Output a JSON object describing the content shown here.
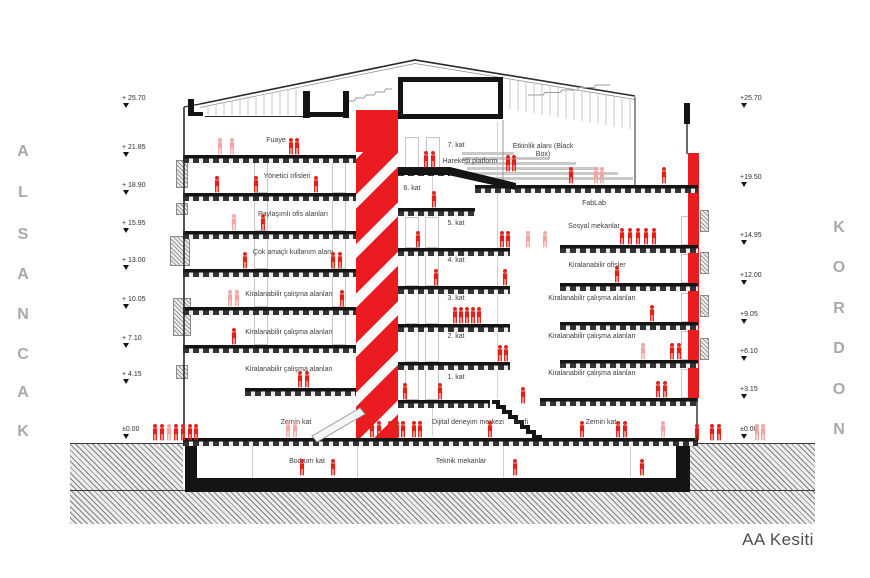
{
  "meta": {
    "title": "AA Kesiti"
  },
  "side_labels": {
    "left": "ALSANCAK",
    "right": "KORDON"
  },
  "colors": {
    "accent": "#ea1c22",
    "figure": "#e32119",
    "figure_light": "#f1a6a4",
    "ink": "#141414",
    "letters": "#a9a9a9"
  },
  "elevations": {
    "left": [
      {
        "label": "+ 25.70",
        "y": 99
      },
      {
        "label": "+ 21.85",
        "y": 148
      },
      {
        "label": "+ 18.90",
        "y": 186
      },
      {
        "label": "+ 15.95",
        "y": 224
      },
      {
        "label": "+ 13.00",
        "y": 261
      },
      {
        "label": "+ 10.05",
        "y": 300
      },
      {
        "label": "+ 7.10",
        "y": 339
      },
      {
        "label": "+ 4.15",
        "y": 375
      },
      {
        "label": "±0.00",
        "y": 430
      }
    ],
    "right": [
      {
        "label": "+25.70",
        "y": 99
      },
      {
        "label": "+19.50",
        "y": 178
      },
      {
        "label": "+14.95",
        "y": 236
      },
      {
        "label": "+12.00",
        "y": 276
      },
      {
        "label": "+9.05",
        "y": 315
      },
      {
        "label": "+6.10",
        "y": 352
      },
      {
        "label": "+3.15",
        "y": 390
      },
      {
        "label": "±0.00",
        "y": 430
      }
    ]
  },
  "rooms": [
    {
      "t": "Fuaye",
      "x": 276,
      "y": 141,
      "w": 80
    },
    {
      "t": "Yönetici ofisleri",
      "x": 287,
      "y": 177,
      "w": 90
    },
    {
      "t": "Paylaşımlı ofis alanları",
      "x": 293,
      "y": 215,
      "w": 110
    },
    {
      "t": "Çok amaçlı kullanım alanı",
      "x": 293,
      "y": 253,
      "w": 120
    },
    {
      "t": "Kiralanabilir çalışma alanları",
      "x": 289,
      "y": 295,
      "w": 95
    },
    {
      "t": "Kiralanabilir çalışma alanları",
      "x": 289,
      "y": 333,
      "w": 95
    },
    {
      "t": "Kiralanabilir çalışma alanları",
      "x": 289,
      "y": 370,
      "w": 95
    },
    {
      "t": "Zemin kat",
      "x": 296,
      "y": 423,
      "w": 60
    },
    {
      "t": "Bodrum kat",
      "x": 307,
      "y": 462,
      "w": 70
    },
    {
      "t": "7. kat",
      "x": 456,
      "y": 146,
      "w": 40
    },
    {
      "t": "Hareketli platform",
      "x": 470,
      "y": 162,
      "w": 115
    },
    {
      "t": "6. kat",
      "x": 412,
      "y": 189,
      "w": 40
    },
    {
      "t": "5. kat",
      "x": 456,
      "y": 224,
      "w": 40
    },
    {
      "t": "4. kat",
      "x": 456,
      "y": 261,
      "w": 40
    },
    {
      "t": "3. kat",
      "x": 456,
      "y": 299,
      "w": 40
    },
    {
      "t": "2. kat",
      "x": 456,
      "y": 337,
      "w": 40
    },
    {
      "t": "1. kat",
      "x": 456,
      "y": 378,
      "w": 40
    },
    {
      "t": "Dijital deneyim merkezi",
      "x": 468,
      "y": 423,
      "w": 115
    },
    {
      "t": "Amfi",
      "x": 521,
      "y": 423,
      "w": 40
    },
    {
      "t": "Zemin kat",
      "x": 601,
      "y": 423,
      "w": 60
    },
    {
      "t": "Teknik mekanlar",
      "x": 461,
      "y": 462,
      "w": 95
    },
    {
      "t": "Etkinlik alanı (Black Box)",
      "x": 543,
      "y": 151,
      "w": 75
    },
    {
      "t": "FabLab",
      "x": 594,
      "y": 204,
      "w": 60
    },
    {
      "t": "Sosyal mekanlar",
      "x": 594,
      "y": 227,
      "w": 90
    },
    {
      "t": "Kiralanabilir ofisler",
      "x": 597,
      "y": 266,
      "w": 100
    },
    {
      "t": "Kiralanabilir çalışma alanları",
      "x": 592,
      "y": 299,
      "w": 98
    },
    {
      "t": "Kiralanabilir çalışma alanları",
      "x": 592,
      "y": 337,
      "w": 98
    },
    {
      "t": "Kiralanabilir çalışma alanları",
      "x": 592,
      "y": 374,
      "w": 98
    }
  ],
  "people": [
    [
      155,
      441
    ],
    [
      162,
      441
    ],
    [
      169,
      441,
      "l"
    ],
    [
      176,
      441
    ],
    [
      183,
      441
    ],
    [
      190,
      441
    ],
    [
      196,
      441
    ],
    [
      220,
      155,
      "l"
    ],
    [
      232,
      155,
      "l"
    ],
    [
      291,
      155
    ],
    [
      297,
      155
    ],
    [
      426,
      168
    ],
    [
      433,
      168
    ],
    [
      508,
      172
    ],
    [
      514,
      172
    ],
    [
      571,
      184
    ],
    [
      596,
      184,
      "l"
    ],
    [
      602,
      184,
      "l"
    ],
    [
      664,
      184
    ],
    [
      217,
      193
    ],
    [
      256,
      193
    ],
    [
      316,
      193
    ],
    [
      434,
      208
    ],
    [
      234,
      231,
      "l"
    ],
    [
      263,
      231
    ],
    [
      418,
      248
    ],
    [
      502,
      248
    ],
    [
      508,
      248
    ],
    [
      528,
      248,
      "l"
    ],
    [
      545,
      248,
      "l"
    ],
    [
      622,
      245
    ],
    [
      630,
      245
    ],
    [
      638,
      245
    ],
    [
      646,
      245
    ],
    [
      654,
      245
    ],
    [
      245,
      269
    ],
    [
      333,
      269
    ],
    [
      340,
      269
    ],
    [
      436,
      286
    ],
    [
      505,
      286
    ],
    [
      617,
      283
    ],
    [
      230,
      307,
      "l"
    ],
    [
      237,
      307,
      "l"
    ],
    [
      342,
      307
    ],
    [
      455,
      324
    ],
    [
      461,
      324
    ],
    [
      467,
      324
    ],
    [
      473,
      324
    ],
    [
      479,
      324
    ],
    [
      652,
      322
    ],
    [
      234,
      345
    ],
    [
      500,
      362
    ],
    [
      506,
      362
    ],
    [
      643,
      360,
      "l"
    ],
    [
      672,
      360
    ],
    [
      679,
      360
    ],
    [
      300,
      388
    ],
    [
      307,
      388
    ],
    [
      405,
      400
    ],
    [
      440,
      400
    ],
    [
      658,
      398
    ],
    [
      665,
      398
    ],
    [
      523,
      404
    ],
    [
      288,
      438,
      "l"
    ],
    [
      295,
      438,
      "l"
    ],
    [
      372,
      438
    ],
    [
      379,
      438
    ],
    [
      390,
      438
    ],
    [
      397,
      438
    ],
    [
      403,
      438
    ],
    [
      414,
      438
    ],
    [
      420,
      438
    ],
    [
      490,
      438
    ],
    [
      582,
      438
    ],
    [
      618,
      438
    ],
    [
      625,
      438
    ],
    [
      663,
      438,
      "l"
    ],
    [
      697,
      441
    ],
    [
      712,
      441
    ],
    [
      719,
      441
    ],
    [
      757,
      441,
      "l"
    ],
    [
      763,
      441,
      "l"
    ],
    [
      302,
      476
    ],
    [
      333,
      476
    ],
    [
      515,
      476
    ],
    [
      642,
      476
    ]
  ],
  "structure": {
    "slabs": [
      [
        183,
        155,
        173
      ],
      [
        183,
        193,
        173
      ],
      [
        183,
        231,
        173
      ],
      [
        183,
        269,
        173
      ],
      [
        183,
        307,
        173
      ],
      [
        183,
        345,
        173
      ],
      [
        245,
        388,
        111
      ],
      [
        398,
        168,
        52
      ],
      [
        398,
        208,
        77
      ],
      [
        398,
        248,
        112
      ],
      [
        398,
        286,
        112
      ],
      [
        398,
        324,
        112
      ],
      [
        398,
        362,
        112
      ],
      [
        398,
        400,
        92
      ],
      [
        475,
        185,
        223
      ],
      [
        560,
        245,
        138
      ],
      [
        560,
        283,
        138
      ],
      [
        560,
        322,
        138
      ],
      [
        560,
        360,
        138
      ],
      [
        540,
        398,
        158
      ],
      [
        183,
        438,
        515
      ]
    ],
    "frames": [
      [
        254,
        161,
        12,
        30
      ],
      [
        332,
        161,
        12,
        30
      ],
      [
        254,
        199,
        12,
        30
      ],
      [
        332,
        199,
        12,
        30
      ],
      [
        254,
        237,
        12,
        30
      ],
      [
        332,
        237,
        12,
        30
      ],
      [
        254,
        275,
        12,
        30
      ],
      [
        332,
        275,
        12,
        30
      ],
      [
        254,
        313,
        12,
        30
      ],
      [
        332,
        313,
        12,
        30
      ],
      [
        405,
        137,
        12,
        29
      ],
      [
        426,
        137,
        12,
        29
      ],
      [
        405,
        217,
        12,
        29
      ],
      [
        425,
        217,
        12,
        29
      ],
      [
        405,
        255,
        12,
        29
      ],
      [
        425,
        255,
        12,
        29
      ],
      [
        405,
        293,
        12,
        29
      ],
      [
        425,
        293,
        12,
        29
      ],
      [
        405,
        331,
        12,
        29
      ],
      [
        425,
        331,
        12,
        29
      ],
      [
        405,
        369,
        12,
        29
      ],
      [
        425,
        369,
        12,
        29
      ],
      [
        681,
        216,
        12,
        27
      ],
      [
        681,
        254,
        12,
        27
      ],
      [
        681,
        293,
        12,
        27
      ],
      [
        681,
        331,
        12,
        27
      ],
      [
        681,
        369,
        12,
        27
      ]
    ],
    "panels": [
      [
        170,
        236,
        18,
        28
      ],
      [
        173,
        298,
        16,
        36
      ],
      [
        176,
        160,
        10,
        26
      ],
      [
        176,
        203,
        10,
        10
      ],
      [
        176,
        365,
        10,
        12
      ],
      [
        700,
        210,
        7,
        20
      ],
      [
        700,
        252,
        7,
        20
      ],
      [
        700,
        295,
        7,
        20
      ],
      [
        700,
        338,
        7,
        20
      ]
    ],
    "seats": [
      [
        462,
        152,
        52
      ],
      [
        462,
        157,
        88
      ],
      [
        464,
        162,
        112
      ],
      [
        467,
        167,
        132
      ],
      [
        470,
        172,
        148
      ],
      [
        473,
        177,
        160
      ]
    ],
    "grid": [
      [
        432,
        155,
        281
      ],
      [
        497,
        122,
        276
      ]
    ],
    "basement_lines": [
      [
        252,
        446,
        32
      ],
      [
        357,
        446,
        32
      ],
      [
        503,
        446,
        32
      ],
      [
        630,
        446,
        32
      ]
    ],
    "ground": [
      [
        70,
        443,
        113,
        80
      ],
      [
        690,
        443,
        125,
        80
      ],
      [
        70,
        490,
        745,
        33
      ]
    ],
    "solids": [
      [
        185,
        443,
        12,
        49
      ],
      [
        676,
        443,
        14,
        49
      ],
      [
        185,
        478,
        505,
        14
      ]
    ],
    "basement_interior": [
      197,
      446,
      479,
      34
    ],
    "core": [
      356,
      110,
      42,
      328
    ],
    "core_top": [
      356,
      110,
      42,
      42
    ],
    "red_strip": [
      688,
      153,
      11,
      245
    ]
  }
}
